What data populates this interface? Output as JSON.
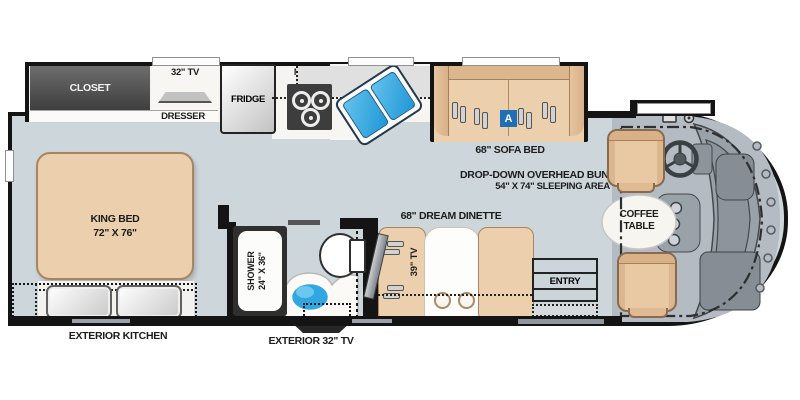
{
  "labels": {
    "closet": "CLOSET",
    "tv_32": "32\" TV",
    "dresser": "DRESSER",
    "fridge": "FRIDGE",
    "micro": "MICRO",
    "sofa_bed": "68\" SOFA BED",
    "sofa_badge": "A",
    "bunk_line1": "DROP-DOWN OVERHEAD BUNK",
    "bunk_line2": "54\" X 74\" SLEEPING AREA",
    "king_bed_line1": "KING BED",
    "king_bed_line2": "72\" X 76\"",
    "exterior_kitchen": "EXTERIOR KITCHEN",
    "shower_line1": "SHOWER",
    "shower_line2": "24\" X 36\"",
    "exterior_tv": "EXTERIOR 32\" TV",
    "dinette": "68\" DREAM DINETTE",
    "tv_39": "39\" TV",
    "entry": "ENTRY",
    "coffee_line1": "COFFEE",
    "coffee_line2": "TABLE"
  },
  "colors": {
    "floor": "#cdd6db",
    "wall": "#141414",
    "furniture_tan": "#eccfad",
    "closet_gray": "#4a4a4a",
    "counter_white": "#f5f4f1",
    "sink_blue": "#2fa7e0",
    "badge_blue": "#1e6fb5",
    "cab_gray": "#b4bbc2"
  }
}
